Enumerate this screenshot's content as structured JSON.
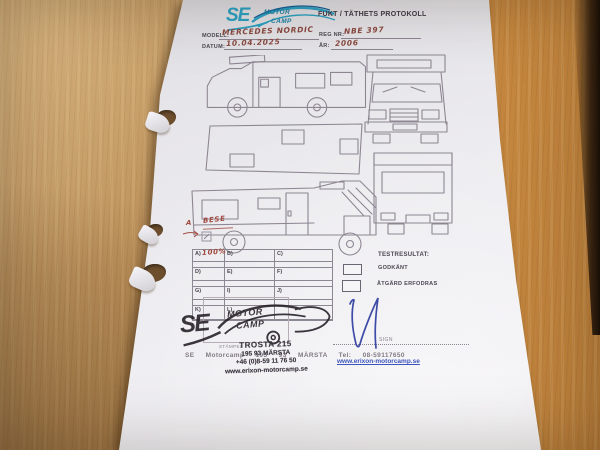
{
  "paper": {
    "logo": {
      "se": "SE",
      "motor": "MOTOR",
      "camp": "CAMP"
    },
    "title": "FUKT / TÄTHETS PROTOKOLL",
    "fields": {
      "modell_label": "MODELL:",
      "modell_value": "MERCEDES NORDIC",
      "regnr_label": "REG NR:",
      "regnr_value": "NBE 397",
      "datum_label": "DATUM:",
      "datum_value": "10.04.2025",
      "ar_label": "ÅR:",
      "ar_value": "2006"
    },
    "annotations": {
      "a_mark": "A",
      "bese": "BESE",
      "cell_a_value": "100%"
    },
    "grid": {
      "cells": [
        "A)",
        "B)",
        "C)",
        "D)",
        "E)",
        "F)",
        "G)",
        "I)",
        "J)",
        "K)",
        "L)",
        ""
      ]
    },
    "testresultat": {
      "label": "TESTRESULTAT:",
      "godkant": "GODKÄNT",
      "atgard": "ÅTGÄRD ERFODRAS"
    },
    "stamp": {
      "se": "SE",
      "motor": "MOTOR",
      "camp": "CAMP",
      "address_line1": "TROSTA 215",
      "address_line2": "195 93 MÄRSTA",
      "address_line3": "+46 (0)8-59 11 76 50",
      "address_line4": "www.erixon-motorcamp.se"
    },
    "footer": {
      "stampel_label": "STÄMPEL",
      "sign_label": "SIGN",
      "company_line": "SE Motorcamp 195 93 MÄRSTA Tel: 08-59117650",
      "website": "www.erixon-motorcamp.se"
    }
  },
  "colors": {
    "logo_teal": "#2ba3c4",
    "handwriting_ink": "#8a4a40",
    "stamp_ink": "#221c24",
    "link_blue": "#3c55bd",
    "paper": "#ecebef",
    "wood": "#bf8f55"
  }
}
